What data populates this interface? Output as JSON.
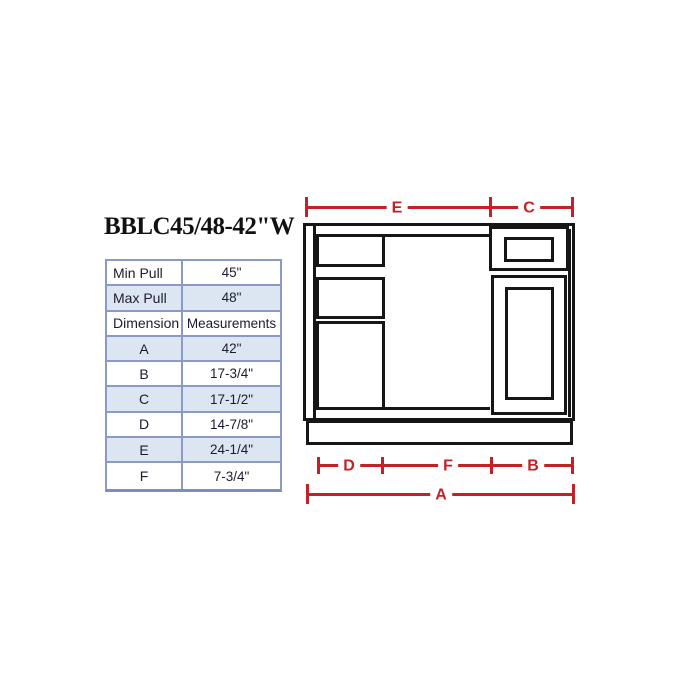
{
  "title": "BBLC45/48-42\"W",
  "table": {
    "rows": [
      {
        "label": "Min Pull",
        "value": "45\""
      },
      {
        "label": "Max Pull",
        "value": "48\""
      },
      {
        "label": "Dimension",
        "value": "Measurements"
      },
      {
        "label": "A",
        "value": "42\""
      },
      {
        "label": "B",
        "value": "17-3/4\""
      },
      {
        "label": "C",
        "value": "17-1/2\""
      },
      {
        "label": "D",
        "value": "14-7/8\""
      },
      {
        "label": "E",
        "value": "24-1/4\""
      },
      {
        "label": "F",
        "value": "7-3/4\""
      }
    ]
  },
  "diagram": {
    "dimension_labels": {
      "top_left": "E",
      "top_right": "C",
      "base_left": "D",
      "base_center": "F",
      "base_right": "B",
      "overall": "A"
    }
  },
  "colors": {
    "dimension_red": "#c42127",
    "drawing_black": "#161616",
    "table_border_blue": "#8a9ac4",
    "table_alt_row_fill": "#dce6f2",
    "text": "#1c1c30"
  }
}
